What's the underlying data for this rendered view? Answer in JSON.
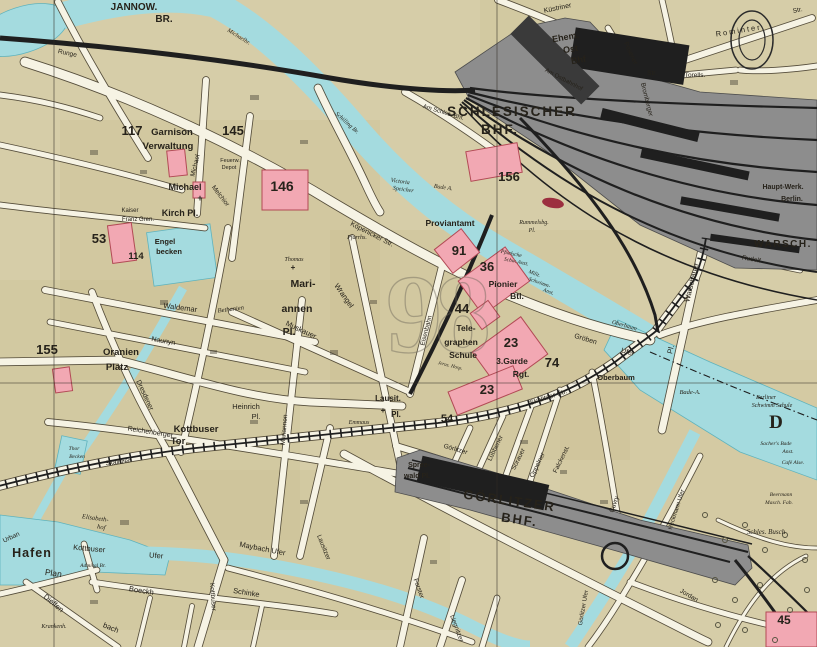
{
  "map_type": "historical city map sheet (Berlin east, Spree / Schlesischer Bhf / Görlitzer Bhf area)",
  "colors": {
    "paper": "#d6cda8",
    "tint": "#c4b685",
    "water": "#a4dbdf",
    "water_stroke": "#5fb3bd",
    "street": "#f6f3e4",
    "casing": "#473f2f",
    "rail_yard": "#8d8d8d",
    "rail_dark": "#1f1f1f",
    "building_pink": "#f2a8b3",
    "building_pink_stroke": "#b24a55",
    "number_red": "#8c1b20",
    "number_dark": "#2a2420",
    "ink": "#26221a",
    "ghost": "#6e675a",
    "label_on_dark": "#f3edd6"
  },
  "labels": [
    {
      "t": "9",
      "x": 414,
      "y": 352,
      "s": 112,
      "g": 1
    },
    {
      "t": "8",
      "x": 463,
      "y": 352,
      "s": 112,
      "g": 1
    },
    {
      "t": "JANNOW.",
      "x": 134,
      "y": 10,
      "s": 10,
      "w": 700
    },
    {
      "t": "BR.",
      "x": 164,
      "y": 22,
      "s": 10,
      "w": 700
    },
    {
      "t": "Michaelbr.",
      "x": 238,
      "y": 38,
      "s": 6,
      "i": 1,
      "r": 32
    },
    {
      "t": "Runge",
      "x": 67,
      "y": 55,
      "s": 6.5,
      "r": 12
    },
    {
      "t": "Küstriner",
      "x": 558,
      "y": 10,
      "s": 7,
      "r": -12
    },
    {
      "t": "Ehem.",
      "x": 566,
      "y": 40,
      "s": 9,
      "w": 700,
      "c": "#f3edd6",
      "r": -10
    },
    {
      "t": "Ost",
      "x": 571,
      "y": 52,
      "s": 9,
      "w": 700,
      "c": "#f3edd6",
      "r": -10
    },
    {
      "t": "Bhf",
      "x": 579,
      "y": 63,
      "s": 9,
      "w": 700,
      "c": "#f3edd6",
      "r": -10
    },
    {
      "t": "Am Ostbahnhof",
      "x": 563,
      "y": 81,
      "s": 6,
      "r": 28
    },
    {
      "t": "Posener",
      "x": 629,
      "y": 54,
      "s": 6.5,
      "r": 65
    },
    {
      "t": "Str.",
      "x": 652,
      "y": 75,
      "s": 6.5
    },
    {
      "t": "Torells.",
      "x": 695,
      "y": 77,
      "s": 6.5
    },
    {
      "t": "Bromberger",
      "x": 645,
      "y": 100,
      "s": 6.5,
      "r": 76
    },
    {
      "t": "Rominter",
      "x": 739,
      "y": 33,
      "s": 7.5,
      "sp": 2,
      "r": -9
    },
    {
      "t": "Str.",
      "x": 798,
      "y": 12,
      "s": 6.5,
      "r": -12
    },
    {
      "t": "SCHLESISCHER",
      "x": 512,
      "y": 116,
      "s": 13.5,
      "w": 700,
      "sp": 2
    },
    {
      "t": "BHF.",
      "x": 500,
      "y": 134,
      "s": 13.5,
      "w": 700,
      "sp": 2
    },
    {
      "t": "Am Schles. Bhf.",
      "x": 443,
      "y": 114,
      "s": 6,
      "r": 17
    },
    {
      "t": "156",
      "x": 509,
      "y": 181,
      "s": 13,
      "w": 700,
      "c": "num"
    },
    {
      "t": "Victoria",
      "x": 400,
      "y": 183,
      "s": 6,
      "i": 1,
      "r": 8
    },
    {
      "t": "Speicher",
      "x": 403,
      "y": 191,
      "s": 6,
      "i": 1,
      "r": 8
    },
    {
      "t": "Bade A.",
      "x": 443,
      "y": 189,
      "s": 6,
      "i": 1,
      "r": 8
    },
    {
      "t": "Schilling Br.",
      "x": 346,
      "y": 124,
      "s": 6,
      "i": 1,
      "r": 42
    },
    {
      "t": "Proviantamt",
      "x": 450,
      "y": 226,
      "s": 8.5,
      "w": 600
    },
    {
      "t": "Rummelsbg.",
      "x": 534,
      "y": 224,
      "s": 6,
      "i": 1
    },
    {
      "t": "Pl.",
      "x": 532,
      "y": 232,
      "s": 6,
      "i": 1
    },
    {
      "t": "117",
      "x": 132,
      "y": 135,
      "s": 13,
      "w": 700,
      "c": "#2a2420"
    },
    {
      "t": "Garnison",
      "x": 172,
      "y": 135,
      "s": 9.5,
      "w": 600
    },
    {
      "t": "Verwaltung",
      "x": 168,
      "y": 149,
      "s": 9.5,
      "w": 600
    },
    {
      "t": "145",
      "x": 233,
      "y": 135,
      "s": 13,
      "w": 700,
      "c": "#2a2420"
    },
    {
      "t": "Feuerw.",
      "x": 230,
      "y": 162,
      "s": 5.5
    },
    {
      "t": "Depot",
      "x": 229,
      "y": 169,
      "s": 5.5
    },
    {
      "t": "146",
      "x": 282,
      "y": 191,
      "s": 14,
      "w": 700,
      "c": "num"
    },
    {
      "t": "Michael",
      "x": 197,
      "y": 166,
      "s": 6.5,
      "r": -76
    },
    {
      "t": "Melchior",
      "x": 219,
      "y": 197,
      "s": 6.5,
      "r": 52
    },
    {
      "t": "Michael",
      "x": 185,
      "y": 190,
      "s": 9,
      "w": 600
    },
    {
      "t": "Kirch Pl.",
      "x": 180,
      "y": 216,
      "s": 9,
      "w": 600
    },
    {
      "t": "+",
      "x": 200,
      "y": 201,
      "s": 9,
      "w": 700
    },
    {
      "t": "Kaiser",
      "x": 130,
      "y": 212,
      "s": 6
    },
    {
      "t": "Franz Gren.",
      "x": 138,
      "y": 221,
      "s": 6
    },
    {
      "t": "53",
      "x": 99,
      "y": 243,
      "s": 13,
      "w": 700,
      "c": "num"
    },
    {
      "t": "114",
      "x": 136,
      "y": 259,
      "s": 9.5,
      "w": 700,
      "c": "num"
    },
    {
      "t": "Engel",
      "x": 165,
      "y": 244,
      "s": 7.5,
      "w": 600
    },
    {
      "t": "becken",
      "x": 169,
      "y": 254,
      "s": 7.5,
      "w": 600
    },
    {
      "t": "Köpenicker Str.",
      "x": 371,
      "y": 236,
      "s": 7,
      "r": 27
    },
    {
      "t": "Pfarrhs.",
      "x": 357,
      "y": 239,
      "s": 6,
      "i": 1
    },
    {
      "t": "Thomas",
      "x": 294,
      "y": 261,
      "s": 6,
      "i": 1
    },
    {
      "t": "+",
      "x": 293,
      "y": 270,
      "s": 8,
      "w": 700
    },
    {
      "t": "Bethanien",
      "x": 231,
      "y": 311,
      "s": 6.5,
      "i": 1,
      "r": -7
    },
    {
      "t": "Mari-",
      "x": 303,
      "y": 287,
      "s": 10.5,
      "w": 600
    },
    {
      "t": "annen",
      "x": 297,
      "y": 312,
      "s": 10.5,
      "w": 600
    },
    {
      "t": "Pl.",
      "x": 289,
      "y": 335,
      "s": 10.5,
      "w": 600
    },
    {
      "t": "Mariannen",
      "x": 286,
      "y": 430,
      "s": 6.5,
      "r": -85
    },
    {
      "t": "Wrangel",
      "x": 342,
      "y": 297,
      "s": 7.5,
      "r": 55
    },
    {
      "t": "Muskauer",
      "x": 300,
      "y": 332,
      "s": 7.5,
      "r": 25
    },
    {
      "t": "Waldemar",
      "x": 180,
      "y": 310,
      "s": 7.5,
      "r": 7
    },
    {
      "t": "Naunyn",
      "x": 163,
      "y": 343,
      "s": 7,
      "r": 10
    },
    {
      "t": "Oranien",
      "x": 121,
      "y": 355,
      "s": 9.5,
      "w": 600
    },
    {
      "t": "Platz",
      "x": 117,
      "y": 370,
      "s": 9.5,
      "w": 600
    },
    {
      "t": "155",
      "x": 47,
      "y": 354,
      "s": 13,
      "w": 700,
      "c": "num"
    },
    {
      "t": "Dresdener",
      "x": 143,
      "y": 396,
      "s": 7,
      "r": 65
    },
    {
      "t": "Heinrich",
      "x": 246,
      "y": 409,
      "s": 7.5
    },
    {
      "t": "Pl.",
      "x": 256,
      "y": 419,
      "s": 7.5
    },
    {
      "t": "Kottbuser",
      "x": 196,
      "y": 432,
      "s": 9.5,
      "w": 600
    },
    {
      "t": "Tor",
      "x": 178,
      "y": 444,
      "s": 9.5,
      "w": 600
    },
    {
      "t": "Reichenberger",
      "x": 150,
      "y": 434,
      "s": 7,
      "r": 9
    },
    {
      "t": "Skalitzer",
      "x": 118,
      "y": 464,
      "s": 6.5,
      "r": -6
    },
    {
      "t": "Thor",
      "x": 74,
      "y": 450,
      "s": 5.5,
      "i": 1
    },
    {
      "t": "Becken",
      "x": 77,
      "y": 458,
      "s": 5.5,
      "i": 1
    },
    {
      "t": "91",
      "x": 459,
      "y": 255,
      "s": 13,
      "w": 700,
      "c": "num"
    },
    {
      "t": "36",
      "x": 487,
      "y": 271,
      "s": 13,
      "w": 700,
      "c": "num"
    },
    {
      "t": "Pionier",
      "x": 503,
      "y": 287,
      "s": 8.5,
      "w": 600
    },
    {
      "t": "Btl.",
      "x": 517,
      "y": 299,
      "s": 8.5,
      "w": 600
    },
    {
      "t": "Pfuelsche",
      "x": 511,
      "y": 255,
      "s": 5.5,
      "i": 1,
      "r": 12
    },
    {
      "t": "Schw. Anst.",
      "x": 516,
      "y": 263,
      "s": 5.5,
      "i": 1,
      "r": 12
    },
    {
      "t": "Milit.",
      "x": 534,
      "y": 275,
      "s": 5.5,
      "i": 1,
      "r": 20
    },
    {
      "t": "Schwimm-",
      "x": 539,
      "y": 284,
      "s": 5.5,
      "i": 1,
      "r": 20
    },
    {
      "t": "Anst.",
      "x": 548,
      "y": 293,
      "s": 5.5,
      "i": 1,
      "r": 20
    },
    {
      "t": "44",
      "x": 462,
      "y": 313,
      "s": 13,
      "w": 700,
      "c": "num"
    },
    {
      "t": "Tele-",
      "x": 466,
      "y": 331,
      "s": 8.5,
      "w": 600
    },
    {
      "t": "graphen",
      "x": 461,
      "y": 345,
      "s": 8.5,
      "w": 600
    },
    {
      "t": "Schule",
      "x": 463,
      "y": 358,
      "s": 8.5,
      "w": 600
    },
    {
      "t": "23",
      "x": 511,
      "y": 347,
      "s": 13,
      "w": 700,
      "c": "num"
    },
    {
      "t": "3.Garde",
      "x": 512,
      "y": 364,
      "s": 8.5,
      "w": 600
    },
    {
      "t": "Rgt.",
      "x": 521,
      "y": 377,
      "s": 8.5,
      "w": 600
    },
    {
      "t": "74",
      "x": 552,
      "y": 367,
      "s": 13,
      "w": 700,
      "c": "#2a2420"
    },
    {
      "t": "23",
      "x": 487,
      "y": 394,
      "s": 13,
      "w": 700,
      "c": "num"
    },
    {
      "t": "Jerus. Hosp.",
      "x": 450,
      "y": 367,
      "s": 5,
      "i": 1,
      "r": 14
    },
    {
      "t": "Eisenbahn",
      "x": 428,
      "y": 331,
      "s": 6.5,
      "r": -76
    },
    {
      "t": "Lausit.",
      "x": 388,
      "y": 401,
      "s": 8,
      "w": 600
    },
    {
      "t": "Pl.",
      "x": 396,
      "y": 417,
      "s": 8,
      "w": 600
    },
    {
      "t": "+",
      "x": 383,
      "y": 413,
      "s": 8,
      "w": 700
    },
    {
      "t": "Emmaus",
      "x": 359,
      "y": 424,
      "s": 6,
      "i": 1
    },
    {
      "t": "54",
      "x": 447,
      "y": 422,
      "s": 11,
      "w": 700,
      "c": "#2a2420"
    },
    {
      "t": "Gröben",
      "x": 585,
      "y": 341,
      "s": 7,
      "r": 17
    },
    {
      "t": "Ufer",
      "x": 627,
      "y": 354,
      "s": 7,
      "r": 17
    },
    {
      "t": "Oberbaum",
      "x": 624,
      "y": 327,
      "s": 6,
      "i": 1,
      "r": 16
    },
    {
      "t": "Oberbaum",
      "x": 616,
      "y": 380,
      "s": 7.5,
      "w": 600
    },
    {
      "t": "Bade-A.",
      "x": 690,
      "y": 394,
      "s": 6.5,
      "i": 1
    },
    {
      "t": "Berliner",
      "x": 766,
      "y": 399,
      "s": 6,
      "i": 1
    },
    {
      "t": "Schwimm Schule",
      "x": 772,
      "y": 407,
      "s": 6,
      "i": 1
    },
    {
      "t": "D",
      "x": 776,
      "y": 428,
      "s": 19,
      "w": 700,
      "f": 1
    },
    {
      "t": "Sacher's Bade",
      "x": 776,
      "y": 445,
      "s": 5.5,
      "i": 1
    },
    {
      "t": "Anst.",
      "x": 788,
      "y": 453,
      "s": 5.5,
      "i": 1
    },
    {
      "t": "Café Alse.",
      "x": 793,
      "y": 464,
      "s": 5.5,
      "i": 1
    },
    {
      "t": "Warschauer",
      "x": 694,
      "y": 283,
      "s": 7.5,
      "r": -76
    },
    {
      "t": "Pl.",
      "x": 673,
      "y": 350,
      "s": 7.5,
      "r": -76
    },
    {
      "t": "Rudolf",
      "x": 751,
      "y": 261,
      "s": 6.5,
      "r": 10
    },
    {
      "t": "Haupt-Werk.",
      "x": 783,
      "y": 189,
      "s": 7,
      "w": 600
    },
    {
      "t": "Berlin.",
      "x": 792,
      "y": 201,
      "s": 7,
      "w": 600
    },
    {
      "t": "WARSCH.",
      "x": 783,
      "y": 247,
      "s": 10,
      "w": 700,
      "sp": 1.5
    },
    {
      "t": "Skalitzer Str.",
      "x": 549,
      "y": 399,
      "s": 7,
      "r": -18
    },
    {
      "t": "Görlitzer",
      "x": 455,
      "y": 451,
      "s": 6.5,
      "r": 16
    },
    {
      "t": "Spree-",
      "x": 419,
      "y": 467,
      "s": 7,
      "w": 600
    },
    {
      "t": "wald Pl.",
      "x": 417,
      "y": 478,
      "s": 7,
      "w": 600
    },
    {
      "t": "GÖRLITZER",
      "x": 509,
      "y": 505,
      "s": 13,
      "w": 700,
      "sp": 2,
      "r": 8
    },
    {
      "t": "BHF.",
      "x": 519,
      "y": 524,
      "s": 13,
      "w": 700,
      "sp": 2,
      "r": 8
    },
    {
      "t": "Lübbener",
      "x": 497,
      "y": 449,
      "s": 6.5,
      "r": -64
    },
    {
      "t": "Sorauer",
      "x": 520,
      "y": 460,
      "s": 6.5,
      "r": -64
    },
    {
      "t": "Oppelner",
      "x": 539,
      "y": 466,
      "s": 6.5,
      "r": -64
    },
    {
      "t": "Falckenst.",
      "x": 563,
      "y": 460,
      "s": 6.5,
      "r": -64
    },
    {
      "t": "Cuvry",
      "x": 616,
      "y": 505,
      "s": 6.5,
      "r": -70
    },
    {
      "t": "Lausitzer",
      "x": 322,
      "y": 548,
      "s": 6.5,
      "r": 68
    },
    {
      "t": "Forster",
      "x": 417,
      "y": 589,
      "s": 6.5,
      "r": 70
    },
    {
      "t": "Liegnitzer",
      "x": 455,
      "y": 629,
      "s": 6.5,
      "r": 70
    },
    {
      "t": "Hafen",
      "x": 32,
      "y": 557,
      "s": 12.5,
      "w": 700,
      "sp": 1
    },
    {
      "t": "Plan",
      "x": 53,
      "y": 576,
      "s": 8.5,
      "r": 8
    },
    {
      "t": "Elisabeth-",
      "x": 95,
      "y": 520,
      "s": 6.5,
      "i": 1,
      "r": 8
    },
    {
      "t": "hof",
      "x": 101,
      "y": 529,
      "s": 6.5,
      "i": 1,
      "r": 8
    },
    {
      "t": "Kottbuser",
      "x": 89,
      "y": 551,
      "s": 7.5,
      "r": 5
    },
    {
      "t": "Ufer",
      "x": 156,
      "y": 558,
      "s": 7.5,
      "r": 5
    },
    {
      "t": "Admiral Br.",
      "x": 93,
      "y": 567,
      "s": 5.5,
      "i": 1
    },
    {
      "t": "Maybach Ufer",
      "x": 262,
      "y": 551,
      "s": 7.5,
      "r": 11
    },
    {
      "t": "Urban",
      "x": 12,
      "y": 539,
      "s": 6.5,
      "r": -25
    },
    {
      "t": "Boeckh",
      "x": 141,
      "y": 593,
      "s": 7.5,
      "r": 9
    },
    {
      "t": "Schinke",
      "x": 246,
      "y": 595,
      "s": 7.5,
      "r": 9
    },
    {
      "t": "Dieffen",
      "x": 52,
      "y": 605,
      "s": 7.5,
      "r": 40
    },
    {
      "t": "bach",
      "x": 110,
      "y": 630,
      "s": 7.5,
      "r": 22
    },
    {
      "t": "Kottbuser",
      "x": 211,
      "y": 597,
      "s": 6.5,
      "r": 86
    },
    {
      "t": "Krankenh.",
      "x": 54,
      "y": 628,
      "s": 6,
      "i": 1
    },
    {
      "t": "Heckmann Ufer",
      "x": 678,
      "y": 510,
      "s": 6,
      "r": -72
    },
    {
      "t": "Görlitzer Ufer",
      "x": 585,
      "y": 608,
      "s": 6,
      "r": -80
    },
    {
      "t": "Jordan",
      "x": 688,
      "y": 597,
      "s": 6.5,
      "r": 30
    },
    {
      "t": "Schles. Busch",
      "x": 766,
      "y": 534,
      "s": 7,
      "i": 1
    },
    {
      "t": "Beermann",
      "x": 781,
      "y": 496,
      "s": 5.5,
      "i": 1
    },
    {
      "t": "Masch. Fab.",
      "x": 779,
      "y": 504,
      "s": 5.5,
      "i": 1
    },
    {
      "t": "45",
      "x": 784,
      "y": 624,
      "s": 12,
      "w": 700,
      "c": "num"
    }
  ]
}
